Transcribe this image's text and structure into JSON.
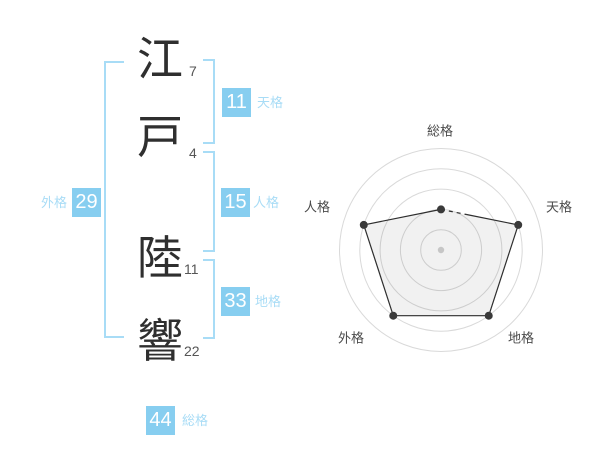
{
  "name_display": {
    "characters": [
      {
        "char": "江",
        "strokes": "7"
      },
      {
        "char": "戸",
        "strokes": "4"
      },
      {
        "char": "陸",
        "strokes": "11"
      },
      {
        "char": "響",
        "strokes": "22"
      }
    ]
  },
  "kaku_badges": {
    "tenkaku": {
      "value": "11",
      "label": "天格"
    },
    "jinkaku": {
      "value": "15",
      "label": "人格"
    },
    "chikaku": {
      "value": "33",
      "label": "地格"
    },
    "gaikaku": {
      "value": "29",
      "label": "外格"
    },
    "soukaku": {
      "value": "44",
      "label": "総格"
    }
  },
  "colors": {
    "badge": "#87CEF0",
    "label": "#A8DCF6",
    "bracket": "#A8DCF6",
    "kanji": "#2F2F2F",
    "stroke_count": "#555555",
    "chart_ring": "#D9D9D9",
    "chart_fill": "rgba(0,0,0,0.055)",
    "chart_line": "#2E2E2E",
    "chart_marker": "#3A3A3A",
    "chart_center_dot": "#C6C6C6",
    "chart_axis_label": "#4A4A4A"
  },
  "chart_data": {
    "type": "radar",
    "axes": [
      "総格",
      "天格",
      "地格",
      "外格",
      "人格"
    ],
    "values": [
      2,
      4,
      4,
      4,
      4
    ],
    "max": 5,
    "rings": 5,
    "grid": "circular",
    "legend": "none"
  }
}
